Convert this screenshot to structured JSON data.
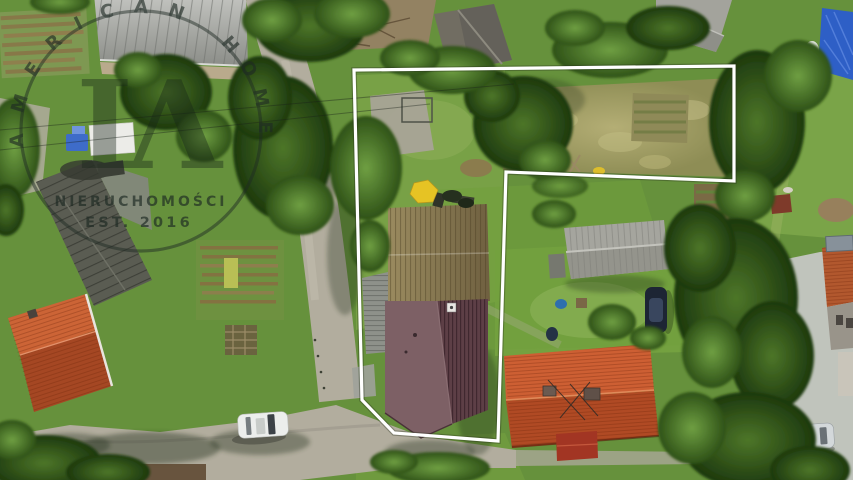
{
  "watermark": {
    "arc_word_1": "AMERICAN",
    "arc_word_2": "HOME",
    "monogram": "IΛ",
    "subtitle": "NIERUCHOMOŚCI",
    "established": "EST. 2016",
    "ink_color": "#1e2a24"
  },
  "scene": {
    "boundary_color": "#ffffff",
    "grass_color": "#66913c",
    "road_color": "#b2ad9e",
    "meadow_color": "#a3a061",
    "roof_colors": {
      "tan_barn": "#8a7b52",
      "maroon_house": "#5d3f46",
      "orange_house": "#c05229",
      "grey_garage": "#a5a59e",
      "dark_barn": "#5a5c52"
    },
    "tarp_color": "#2e5fc6",
    "pavement_color": "#c0c4bc"
  }
}
